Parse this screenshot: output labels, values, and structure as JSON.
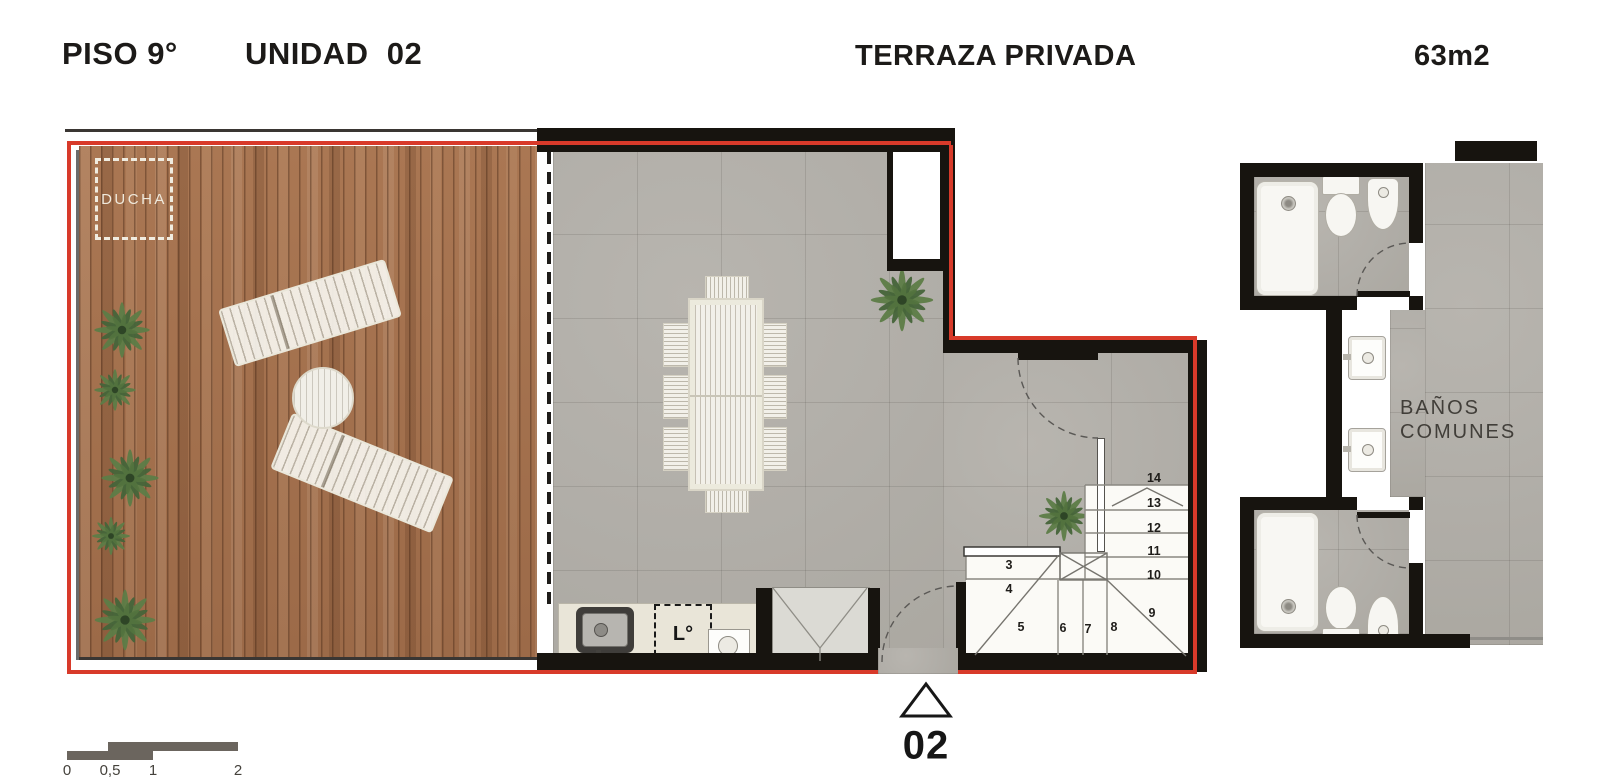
{
  "header": {
    "floor": "PISO 9°",
    "unit": "UNIDAD  02",
    "zone": "TERRAZA PRIVADA",
    "area": "63m2"
  },
  "terrace": {
    "shower_label": "DUCHA"
  },
  "kitchen": {
    "washer_label": "L°"
  },
  "stairs": {
    "steps": [
      "3",
      "4",
      "5",
      "6",
      "7",
      "8",
      "9",
      "10",
      "11",
      "12",
      "13",
      "14"
    ]
  },
  "entry": {
    "marker": "02"
  },
  "common_baths": {
    "line1": "BAÑOS",
    "line2": "COMUNES"
  },
  "scale_bar": {
    "labels": [
      "0",
      "0,5",
      "1",
      "2"
    ]
  },
  "colors": {
    "boundary_red": "#d83a2a",
    "wall_black": "#17140f",
    "deck_wood": "#a4714e",
    "floor_tile": "#b3b0aa",
    "counter_beige": "#e9e5d8",
    "plant_green": "#54743f",
    "furniture_white": "#f3f1ea"
  }
}
